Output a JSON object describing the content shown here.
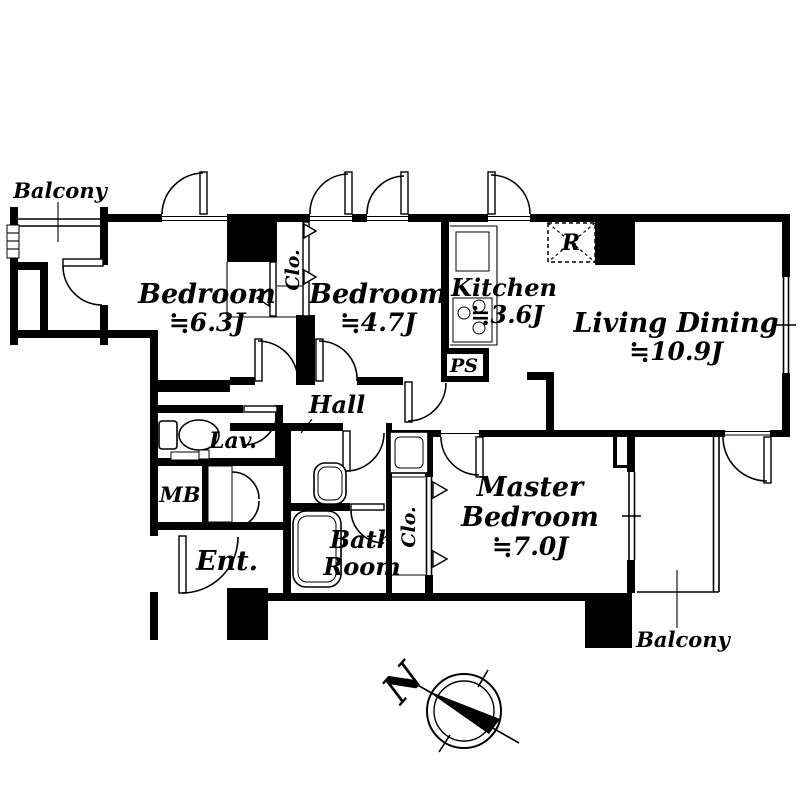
{
  "floorplan": {
    "rooms": {
      "bedroom_1": {
        "name": "Bedroom",
        "area": "≒6.3J"
      },
      "bedroom_2": {
        "name": "Bedroom",
        "area": "≒4.7J"
      },
      "kitchen": {
        "name": "Kitchen",
        "area": "≒3.6J"
      },
      "living_dining": {
        "name": "Living Dining",
        "area": "≒10.9J"
      },
      "master_bedroom": {
        "name_line_1": "Master",
        "name_line_2": "Bedroom",
        "area": "≒7.0J"
      },
      "hall": {
        "name": "Hall"
      },
      "lavatory": {
        "name": "Lav."
      },
      "bathroom": {
        "name_line_1": "Bath",
        "name_line_2": "Room"
      },
      "entrance": {
        "name": "Ent."
      },
      "meter_box": {
        "name": "MB"
      },
      "pipe_space": {
        "name": "PS"
      },
      "closet_upper": {
        "name": "Clo."
      },
      "closet_master": {
        "name": "Clo."
      },
      "refrigerator_space": {
        "name": "R"
      },
      "balcony_upper": {
        "name": "Balcony"
      },
      "balcony_lower": {
        "name": "Balcony"
      }
    },
    "compass": {
      "north": "N"
    },
    "colors": {
      "walls": "#000000",
      "background": "#ffffff"
    }
  }
}
